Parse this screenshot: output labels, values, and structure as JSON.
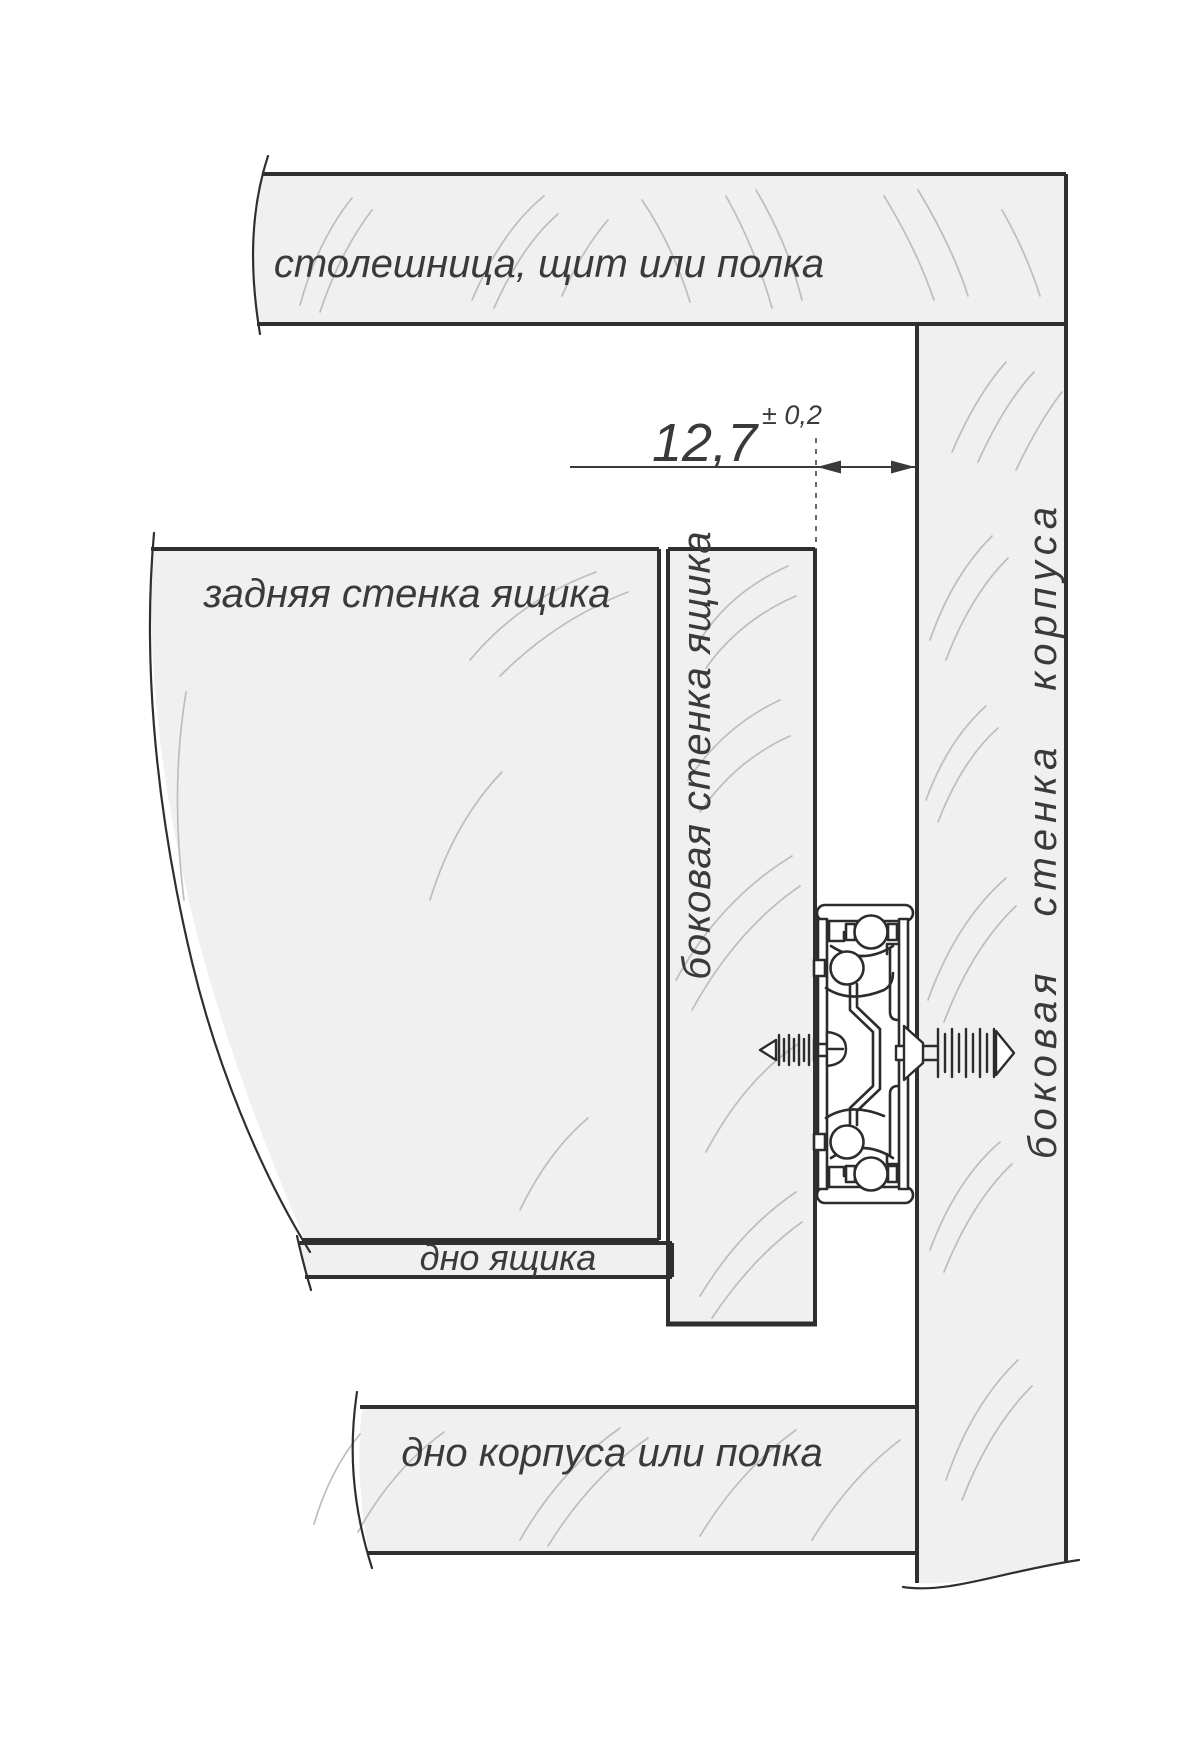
{
  "labels": {
    "top_board": "столешница, щит или полка",
    "back_wall": "задняя стенка ящика",
    "drawer_side_wall": "боковая стенка ящика",
    "cabinet_side_wall": "боковая стенка корпуса",
    "drawer_bottom": "дно ящика",
    "cabinet_bottom": "дно корпуса или полка"
  },
  "dimension": {
    "value": "12,7",
    "tolerance": "± 0,2"
  },
  "colors": {
    "panel_fill": "#f0f0f1",
    "outline": "#2f2f2f",
    "grain": "#bdbdbd",
    "text": "#3a3a3a",
    "background": "#ffffff"
  }
}
